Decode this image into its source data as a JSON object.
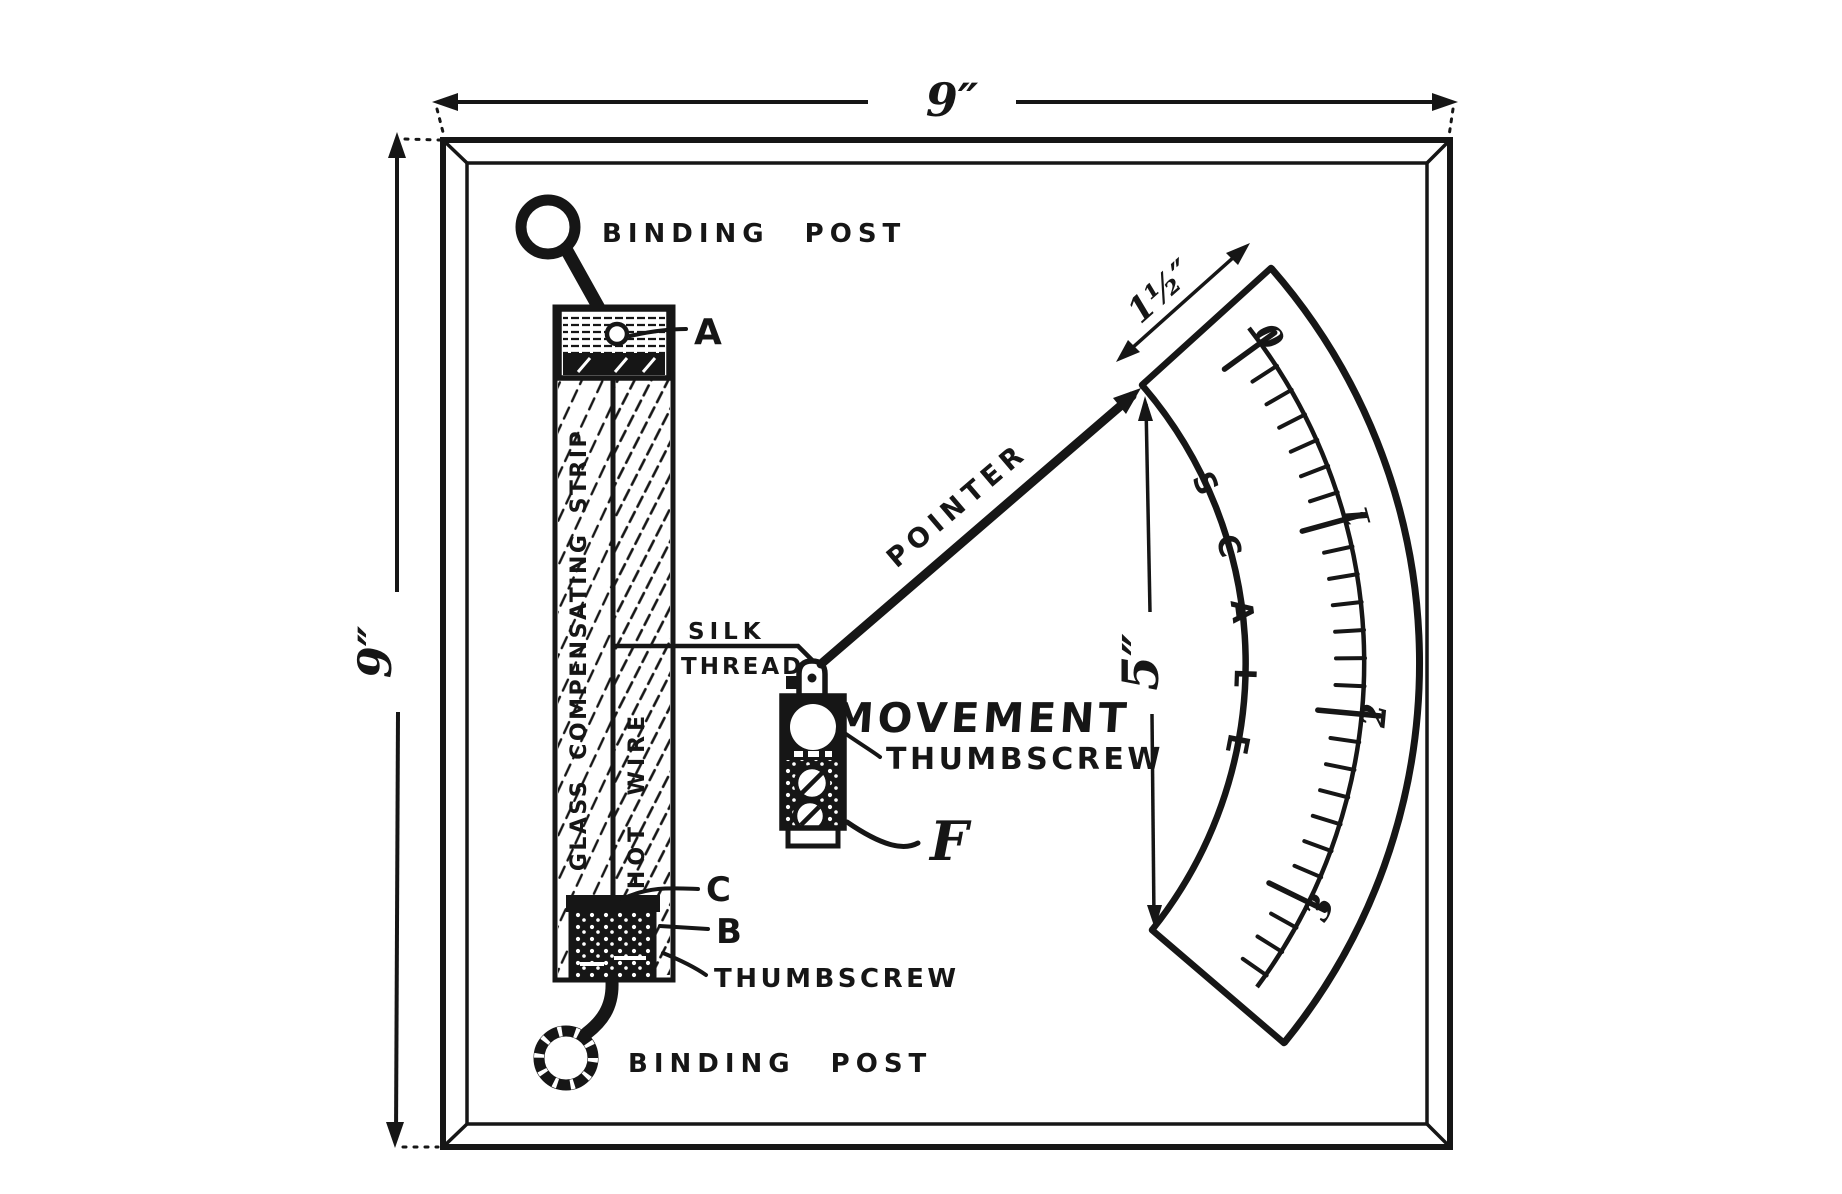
{
  "colors": {
    "ink": "#161616",
    "paper": "#ffffff"
  },
  "dimensions": {
    "board_width": "9″",
    "board_height": "9″",
    "scale_width": "1½″",
    "scale_height": "5″"
  },
  "labels": {
    "binding_post_top": "BINDING POST",
    "binding_post_bottom": "BINDING POST",
    "glass_strip": "GLASS COMPENSATING STRIP",
    "hot_wire": "HOT WIRE",
    "silk_line1": "SILK",
    "silk_line2": "THREAD",
    "pointer": "POINTER",
    "movement": "MOVEMENT",
    "movement_thumbscrew": "THUMBSCREW",
    "strip_thumbscrew": "THUMBSCREW",
    "point_a": "A",
    "point_b": "B",
    "point_c": "C",
    "point_f": "F"
  },
  "scale": {
    "label": "SCALE",
    "graduations": [
      "0",
      "1",
      "2",
      "3"
    ]
  }
}
